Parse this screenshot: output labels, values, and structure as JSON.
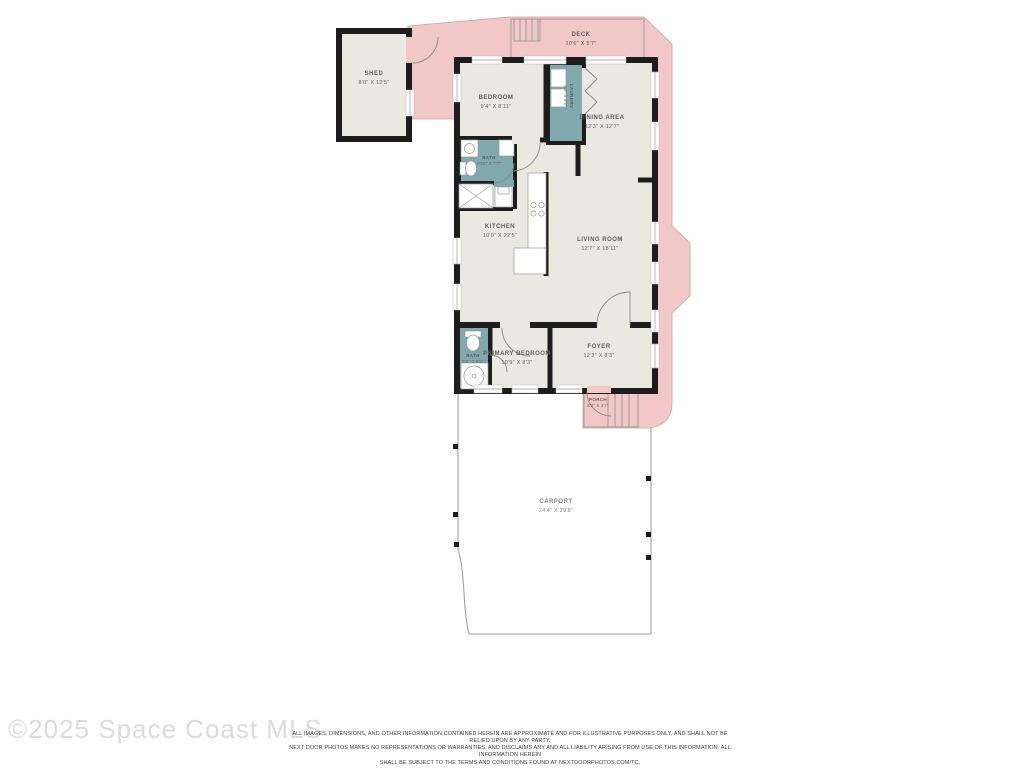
{
  "floorplan": {
    "colors": {
      "exterior_pink": "#f1c7c7",
      "pink_outline": "#cfa3a3",
      "floor_beige": "#e9e9e1",
      "wall_black": "#1d1d1d",
      "wet_area_teal": "#7fa9ad",
      "outline_gray": "#9a9a9a"
    },
    "rooms": {
      "shed": {
        "label": "SHED",
        "dims": "8'0\" X 12'5\""
      },
      "deck": {
        "label": "DECK",
        "dims": "10'6\" X 5'7\""
      },
      "bedroom": {
        "label": "BEDROOM",
        "dims": "9'4\" X 8'11\""
      },
      "laundry": {
        "label": "LAUNDRY",
        "dims": "5'3\" X 2'6\""
      },
      "dining_area": {
        "label": "DINING AREA",
        "dims": "12'3\" X 12'7\""
      },
      "bath_upper": {
        "label": "BATH",
        "dims": "5'10\" X 7'7\""
      },
      "kitchen": {
        "label": "KITCHEN",
        "dims": "10'9\" X 22'5\""
      },
      "living_room": {
        "label": "LIVING ROOM",
        "dims": "12'7\" X 18'11\""
      },
      "bath_lower": {
        "label": "BATH",
        "dims": "5'6\" X 8'5\""
      },
      "primary_bedroom": {
        "label": "PRIMARY BEDROOM",
        "dims": "10'9\" X 8'3\""
      },
      "foyer": {
        "label": "FOYER",
        "dims": "12'3\" X 8'3\""
      },
      "porch": {
        "label": "PORCH",
        "dims": "8'2\" X 3'7\""
      },
      "carport": {
        "label": "CARPORT",
        "dims": "24'4\" X 29'8\""
      }
    },
    "watermark": "©2025 Space Coast MLS",
    "disclaimer": {
      "line1": "ALL IMAGES, DIMENSIONS, AND OTHER INFORMATION CONTAINED HEREIN ARE APPROXIMATE AND FOR ILLUSTRATIVE PURPOSES ONLY, AND SHALL NOT BE RELIED UPON BY ANY PARTY.",
      "line2": "NEXT DOOR PHOTOS MAKES NO REPRESENTATIONS OR WARRANTIES, AND DISCLAIMS ANY AND ALL LIABILITY ARISING FROM USE OF THIS INFORMATION. ALL INFORMATION HEREIN",
      "line3": "SHALL BE SUBJECT TO THE TERMS AND CONDITIONS FOUND AT NEXTDOORPHOTOS.COM/TC."
    }
  }
}
